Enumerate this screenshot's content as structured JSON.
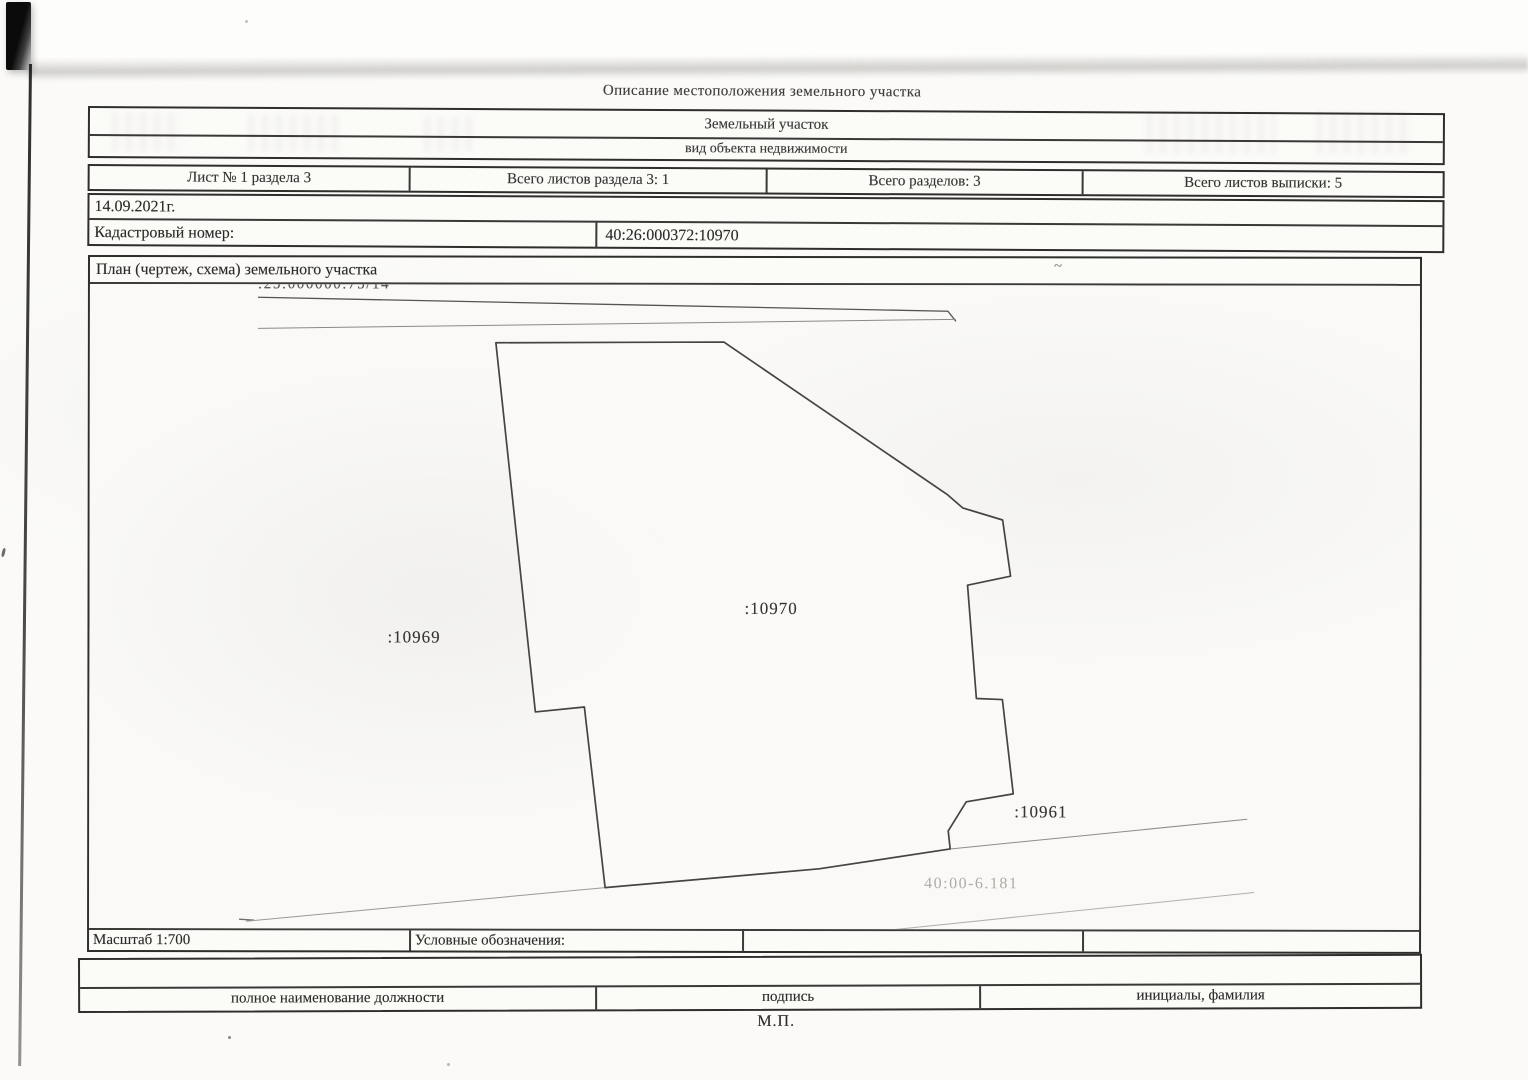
{
  "page": {
    "title": "Описание местоположения земельного участка",
    "stamp_label": "М.П."
  },
  "object_box": {
    "name": "Земельный участок",
    "caption": "вид объекта недвижимости"
  },
  "sheet_row": {
    "cells": [
      "Лист № 1 раздела 3",
      "Всего листов раздела 3: 1",
      "Всего разделов: 3",
      "Всего листов выписки: 5"
    ]
  },
  "meta_box": {
    "date": "14.09.2021г.",
    "cadastral_label": "Кадастровый номер:",
    "cadastral_number": "40:26:000372:10970"
  },
  "plan": {
    "title": "План (чертеж, схема) земельного участка",
    "scale_label": "Масштаб 1:700",
    "legend_label": "Условные обозначения:",
    "labels": {
      "strip_parcel": ":25:000000:75/14",
      "left_parcel": ":10969",
      "main_parcel": ":10970",
      "right_parcel": ":10961",
      "quarter": "40:00-6.181"
    },
    "colors": {
      "parcel_outline": "#454440",
      "faint_line": "#9a9995",
      "border": "#2f2e2c"
    }
  },
  "signature_block": {
    "position_label": "полное наименование должности",
    "signature_label": "подпись",
    "name_label": "инициалы, фамилия"
  }
}
